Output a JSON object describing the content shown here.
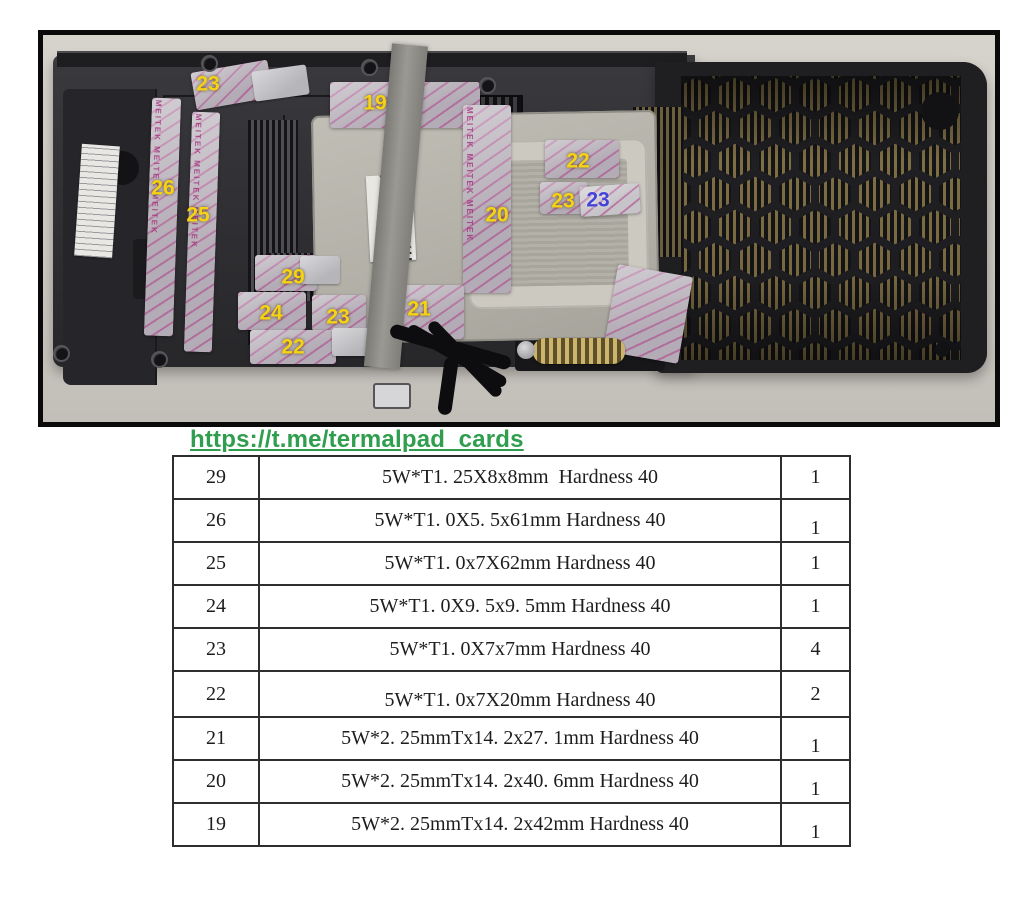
{
  "colors": {
    "link_green": "#2f9e4e",
    "pad_label_yellow": "#f5d312",
    "pad_label_blue": "#4444d8",
    "photo_frame_black": "#0a0a0a",
    "table_border": "#2e2e2e"
  },
  "photo": {
    "description": "Disassembled GPU cooler shroud with thermal pad positions marked by numbers",
    "pad_watermark": "MEITEK MEITEK MEITEK",
    "labels": [
      {
        "id": "label-23-top-left",
        "text": "23",
        "color": "#f5d312"
      },
      {
        "id": "label-19",
        "text": "19",
        "color": "#f5d312"
      },
      {
        "id": "label-26",
        "text": "26",
        "color": "#f5d312"
      },
      {
        "id": "label-25",
        "text": "25",
        "color": "#f5d312"
      },
      {
        "id": "label-22-right",
        "text": "22",
        "color": "#f5d312"
      },
      {
        "id": "label-23-mid-yellow",
        "text": "23",
        "color": "#f5d312"
      },
      {
        "id": "label-23-mid-blue",
        "text": "23",
        "color": "#4444d8"
      },
      {
        "id": "label-20",
        "text": "20",
        "color": "#f5d312"
      },
      {
        "id": "label-29",
        "text": "29",
        "color": "#f5d312"
      },
      {
        "id": "label-24",
        "text": "24",
        "color": "#f5d312"
      },
      {
        "id": "label-23-bottom",
        "text": "23",
        "color": "#f5d312"
      },
      {
        "id": "label-21",
        "text": "21",
        "color": "#f5d312"
      },
      {
        "id": "label-22-bottom",
        "text": "22",
        "color": "#f5d312"
      }
    ]
  },
  "link": {
    "text": "https://t.me/termalpad_cards"
  },
  "table": {
    "columns": [
      "pad_number",
      "specification",
      "quantity"
    ],
    "rows": [
      {
        "num": "29",
        "spec": "5W*T1. 25X8x8mm  Hardness 40",
        "qty": "1"
      },
      {
        "num": "26",
        "spec": "5W*T1. 0X5. 5x61mm Hardness 40",
        "qty": "1"
      },
      {
        "num": "25",
        "spec": "5W*T1. 0x7X62mm Hardness 40",
        "qty": "1"
      },
      {
        "num": "24",
        "spec": "5W*T1. 0X9. 5x9. 5mm Hardness 40",
        "qty": "1"
      },
      {
        "num": "23",
        "spec": "5W*T1. 0X7x7mm Hardness 40",
        "qty": "4"
      },
      {
        "num": "22",
        "spec": "5W*T1. 0x7X20mm Hardness 40",
        "qty": "2"
      },
      {
        "num": "21",
        "spec": "5W*2. 25mmTx14. 2x27. 1mm Hardness 40",
        "qty": "1"
      },
      {
        "num": "20",
        "spec": "5W*2. 25mmTx14. 2x40. 6mm Hardness 40",
        "qty": "1"
      },
      {
        "num": "19",
        "spec": "5W*2. 25mmTx14. 2x42mm Hardness 40",
        "qty": "1"
      }
    ]
  }
}
